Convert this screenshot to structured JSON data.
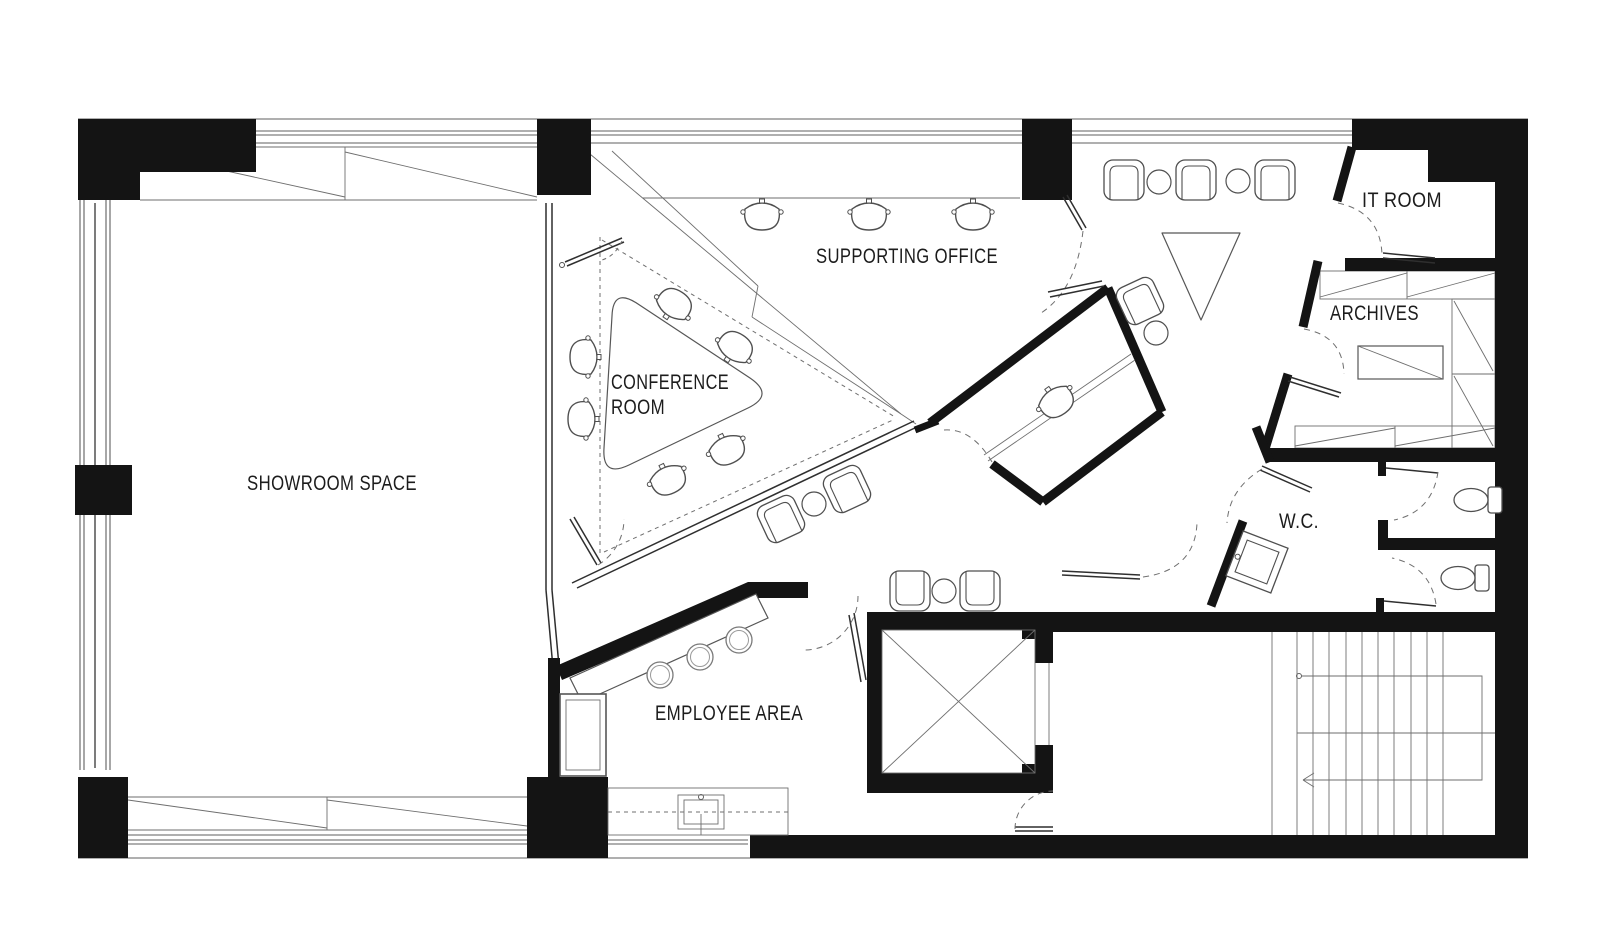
{
  "rooms": {
    "showroom": {
      "label": "SHOWROOM SPACE"
    },
    "conference": {
      "line1": "CONFERENCE",
      "line2": "ROOM"
    },
    "supporting": {
      "label": "SUPPORTING OFFICE"
    },
    "it_room": {
      "label": "IT ROOM"
    },
    "archives": {
      "label": "ARCHIVES"
    },
    "wc": {
      "label": "W.C."
    },
    "employee": {
      "label": "EMPLOYEE AREA"
    }
  },
  "colors": {
    "background": "#ffffff",
    "wall_fill": "#141414",
    "thin_line": "#5f5f5f",
    "glass_line": "#2f2f2f",
    "label_text": "#1c1c1c"
  },
  "furniture": {
    "office_chairs": 10,
    "lounge_chairs": 8,
    "round_side_tables": 5,
    "bar_stools": 3,
    "toilets": 2,
    "sinks": 2,
    "conference_tables": 1,
    "reception_desks": 1,
    "archive_tables": 1,
    "planters": 1,
    "elevators": 1,
    "staircases": 1
  }
}
